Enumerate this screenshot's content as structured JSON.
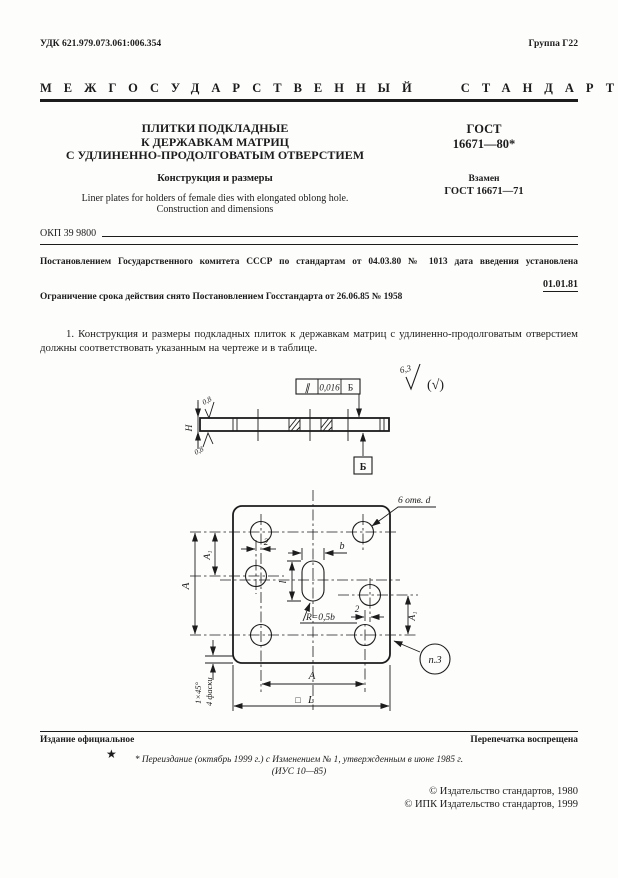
{
  "colors": {
    "paper": "#fdfdfc",
    "ink": "#1c1c1c"
  },
  "header": {
    "udk": "УДК 621.979.073.061:006.354",
    "group": "Группа Г22",
    "standard_type": "МЕЖГОСУДАРСТВЕННЫЙ СТАНДАРТ"
  },
  "title_block": {
    "title_line1": "ПЛИТКИ ПОДКЛАДНЫЕ",
    "title_line2": "К ДЕРЖАВКАМ МАТРИЦ",
    "title_line3": "С УДЛИНЕННО-ПРОДОЛГОВАТЫМ ОТВЕРСТИЕМ",
    "subtitle": "Конструкция и размеры",
    "title_en_line1": "Liner plates for holders of female dies with elongated oblong hole.",
    "title_en_line2": "Construction and dimensions",
    "gost_label": "ГОСТ",
    "gost_number": "16671—80*",
    "replaces_label": "Взамен",
    "replaces_number": "ГОСТ 16671—71",
    "okp": "ОКП 39 9800"
  },
  "decree": {
    "line1": "Постановлением Государственного комитета СССР по стандартам от 04.03.80 № 1013 дата введения установлена",
    "effective_date": "01.01.81",
    "line2": "Ограничение срока действия снято Постановлением Госстандарта от 26.06.85 № 1958"
  },
  "body": {
    "para1": "1. Конструкция и размеры подкладных плиток к державкам матриц с удлиненно-продолговатым отверстием должны соответствовать указанным на чертеже и в таблице."
  },
  "drawing": {
    "general_roughness": "6,3",
    "general_roughness_alt": "(√)",
    "tolerance_symbol": "∥",
    "tolerance_value": "0,016",
    "tolerance_datum": "Б",
    "datum_label": "Б",
    "thickness_label": "Н",
    "roughness_top": "0,8",
    "roughness_bottom": "0,8",
    "holes_note": "6 отв. d",
    "slot_width_label": "b",
    "slot_length_label": "l",
    "radius_note": "R=0,5b",
    "offset_left": "2",
    "offset_right": "2",
    "dim_a_left": "A",
    "dim_a1_left": "A₁",
    "dim_a1_right": "A₁",
    "dim_a_bottom": "A",
    "square_symbol": "□",
    "dim_l_overall": "L",
    "chamfer_size": "1×45°",
    "chamfer_count": "4 фаски",
    "note_reference": "п.3"
  },
  "footer": {
    "official_edition": "Издание официальное",
    "reprint_notice": "Перепечатка воспрещена",
    "star": "★",
    "revision_note_line1": "* Переиздание (октябрь 1999 г.) с Изменением № 1, утвержденным в июне 1985 г.",
    "revision_note_line2": "(ИУС 10—85)",
    "copyright_line1": "© Издательство стандартов, 1980",
    "copyright_line2": "© ИПК Издательство стандартов, 1999"
  }
}
